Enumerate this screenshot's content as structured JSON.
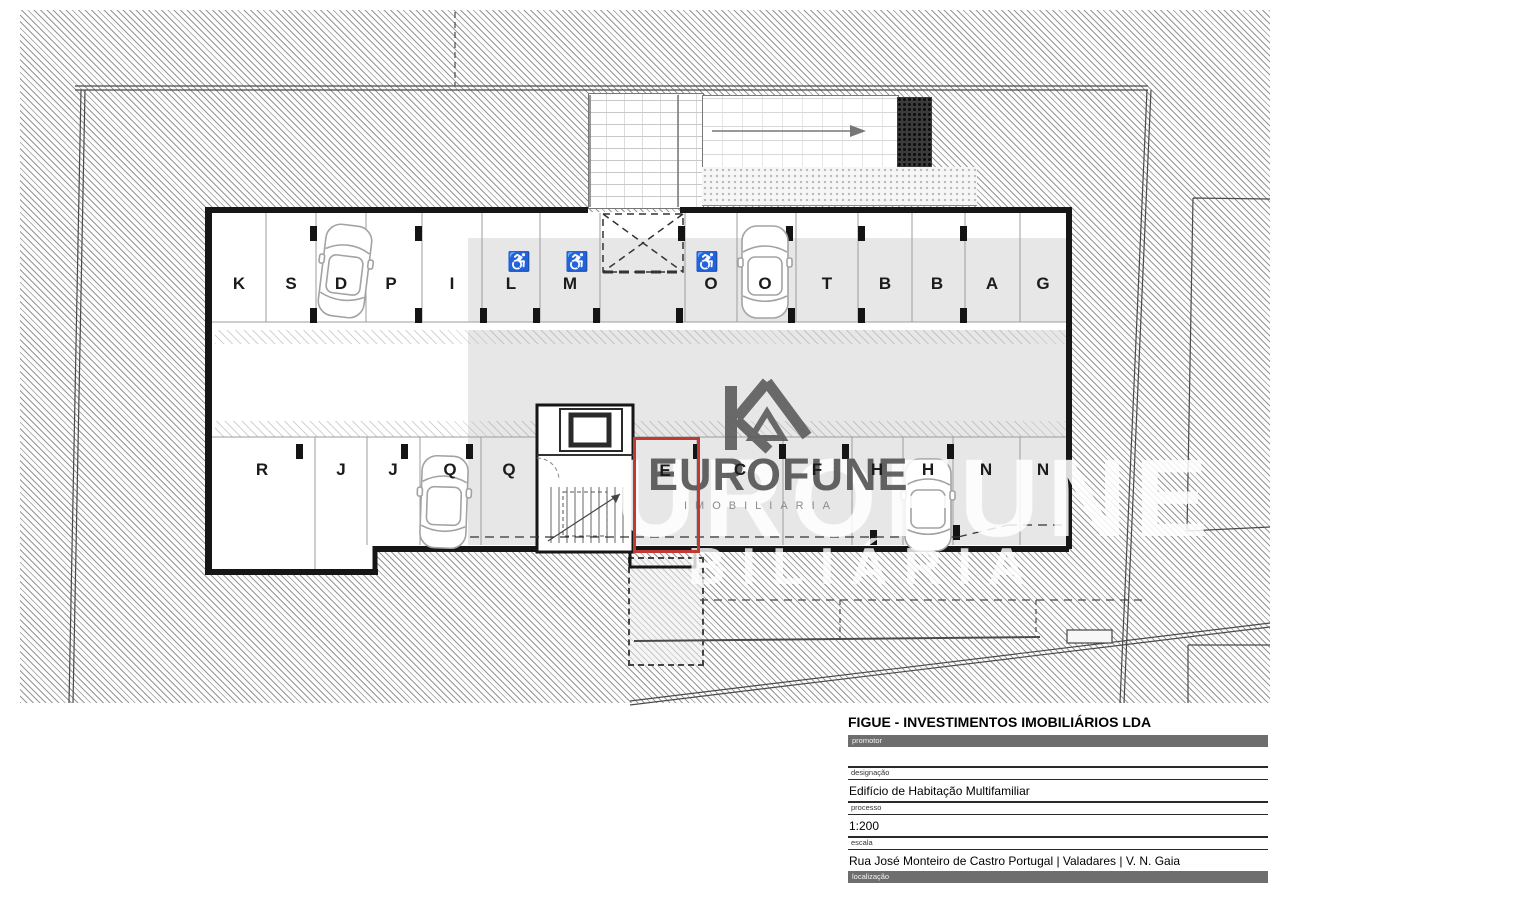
{
  "plan": {
    "top_row": [
      "K",
      "S",
      "D",
      "P",
      "I",
      "L",
      "M",
      "O",
      "O",
      "T",
      "B",
      "B",
      "A",
      "G"
    ],
    "bottom_row": [
      "R",
      "J",
      "J",
      "Q",
      "Q",
      "E",
      "C",
      "F",
      "H",
      "H",
      "N",
      "N"
    ],
    "highlighted_stall": "E",
    "highlight_color": "#bf3a34",
    "accessible_icon": "♿",
    "scale": "1:200"
  },
  "watermark": {
    "brand": "EUROFUNE",
    "brand_large": "UROFUNE",
    "subtitle": "IMOBILIARIA",
    "subtitle_large": "BILIÁRIA"
  },
  "title_block": {
    "company": "FIGUE - INVESTIMENTOS IMOBILIÁRIOS LDA",
    "fields": [
      {
        "label": "promotor",
        "value": ""
      },
      {
        "label": "designação",
        "value": "Edifício de Habitação Multifamiliar"
      },
      {
        "label": "processo",
        "value": "1:200"
      },
      {
        "label": "escala",
        "value": "Rua José Monteiro de Castro Portugal | Valadares | V. N. Gaia"
      },
      {
        "label": "localização",
        "value": ""
      }
    ]
  }
}
